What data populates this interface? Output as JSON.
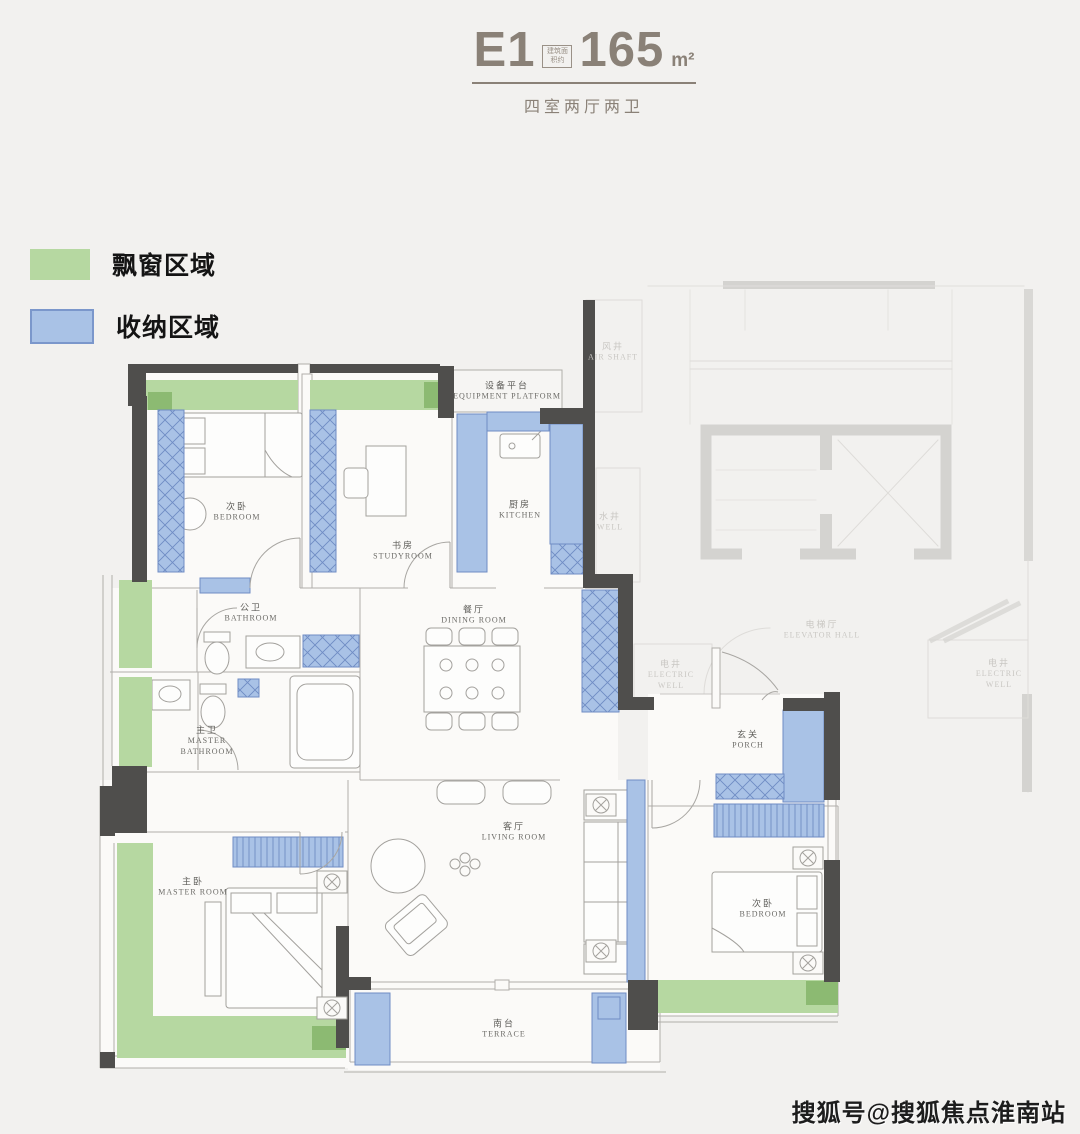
{
  "title": {
    "code": "E1",
    "area_note": "建筑面积约",
    "area": "165",
    "unit": "m²",
    "subtitle": "四室两厅两卫"
  },
  "legend": {
    "items": [
      {
        "label": "飘窗区域",
        "color": "#b6d8a1"
      },
      {
        "label": "收纳区域",
        "color": "#a9c2e6"
      }
    ]
  },
  "colors": {
    "background": "#f2f1ef",
    "wall_dark": "#4f4e4c",
    "bay_window_green": "#b6d8a1",
    "bay_window_green_dark": "#8cba72",
    "storage_blue": "#a9c2e6",
    "storage_blue_border": "#6f8cc4",
    "faded_common": "#d6d5d2",
    "title_text": "#8a8177"
  },
  "rooms": {
    "bedroom_top": {
      "cn": "次卧",
      "en": "BEDROOM"
    },
    "studyroom": {
      "cn": "书房",
      "en": "STUDYROOM"
    },
    "equipment_platform": {
      "cn": "设备平台",
      "en": "EQUIPMENT PLATFORM"
    },
    "air_shaft": {
      "cn": "风井",
      "en": "AIR SHAFT"
    },
    "kitchen": {
      "cn": "厨房",
      "en": "KITCHEN"
    },
    "well": {
      "cn": "水井",
      "en": "WELL"
    },
    "bathroom": {
      "cn": "公卫",
      "en": "BATHROOM"
    },
    "master_bathroom": {
      "cn": "主卫",
      "en": "MASTER BATHROOM"
    },
    "dining_room": {
      "cn": "餐厅",
      "en": "DINING ROOM"
    },
    "electric_well_inner": {
      "cn": "电井",
      "en": "ELECTRIC WELL"
    },
    "elevator_hall": {
      "cn": "电梯厅",
      "en": "ELEVATOR HALL"
    },
    "electric_well_right": {
      "cn": "电井",
      "en": "ELECTRIC WELL"
    },
    "porch": {
      "cn": "玄关",
      "en": "PORCH"
    },
    "living_room": {
      "cn": "客厅",
      "en": "LIVING ROOM"
    },
    "master_room": {
      "cn": "主卧",
      "en": "MASTER ROOM"
    },
    "bedroom_right": {
      "cn": "次卧",
      "en": "BEDROOM"
    },
    "terrace": {
      "cn": "南台",
      "en": "TERRACE"
    }
  },
  "watermark": "搜狐号@搜狐焦点淮南站"
}
